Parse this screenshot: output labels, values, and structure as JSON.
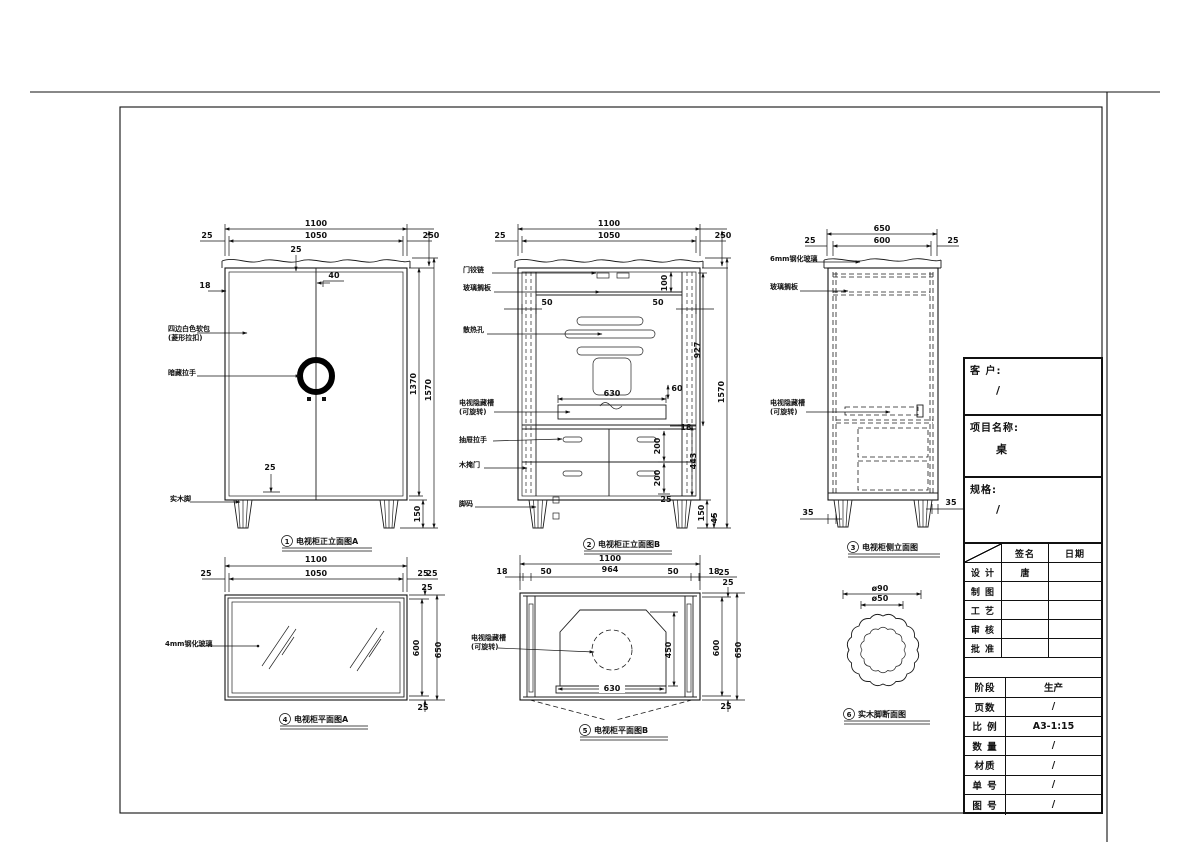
{
  "title_block": {
    "customer_label": "客 户:",
    "customer_value": "/",
    "project_label": "项目名称:",
    "project_value": "桌",
    "spec_label": "规格:",
    "spec_value": "/",
    "sign_col": "签名",
    "date_col": "日期",
    "sign_rows": [
      {
        "label": "设 计",
        "sign": "唐",
        "date": ""
      },
      {
        "label": "制 图",
        "sign": "",
        "date": ""
      },
      {
        "label": "工 艺",
        "sign": "",
        "date": ""
      },
      {
        "label": "审 核",
        "sign": "",
        "date": ""
      },
      {
        "label": "批 准",
        "sign": "",
        "date": ""
      }
    ],
    "info_rows": [
      {
        "label": "阶段",
        "value": "生产"
      },
      {
        "label": "页数",
        "value": "/"
      },
      {
        "label": "比 例",
        "value": "A3-1:15"
      },
      {
        "label": "数 量",
        "value": "/"
      },
      {
        "label": "材质",
        "value": "/"
      },
      {
        "label": "单 号",
        "value": "/"
      },
      {
        "label": "图 号",
        "value": "/"
      }
    ]
  },
  "views": {
    "v1": {
      "num": "1",
      "title": "电视柜正立面图A",
      "annotations": [
        {
          "x": 316,
          "y": 226,
          "t": "1100"
        },
        {
          "x": 207,
          "y": 238,
          "t": "25"
        },
        {
          "x": 316,
          "y": 238,
          "t": "1050"
        },
        {
          "x": 431,
          "y": 238,
          "t": "250"
        },
        {
          "x": 296,
          "y": 252,
          "t": "25"
        },
        {
          "x": 334,
          "y": 278,
          "t": "40"
        },
        {
          "x": 205,
          "y": 288,
          "t": "18"
        },
        {
          "x": 270,
          "y": 470,
          "t": "25"
        },
        {
          "x": 416,
          "y": 384,
          "t": "1370",
          "r": -90
        },
        {
          "x": 431,
          "y": 390,
          "t": "1570",
          "r": -90
        },
        {
          "x": 420,
          "y": 514,
          "t": "150",
          "r": -90
        },
        {
          "x": 168,
          "y": 331,
          "t": "四边白色软包",
          "s": 7,
          "a": "start"
        },
        {
          "x": 168,
          "y": 340,
          "t": "(菱形拉扣)",
          "s": 7,
          "a": "start"
        },
        {
          "x": 168,
          "y": 375,
          "t": "暗藏拉手",
          "s": 7,
          "a": "start"
        },
        {
          "x": 170,
          "y": 501,
          "t": "实木脚",
          "s": 7,
          "a": "start"
        }
      ]
    },
    "v2": {
      "num": "2",
      "title": "电视柜正立面图B",
      "annotations": [
        {
          "x": 609,
          "y": 226,
          "t": "1100"
        },
        {
          "x": 500,
          "y": 238,
          "t": "25"
        },
        {
          "x": 609,
          "y": 238,
          "t": "1050"
        },
        {
          "x": 723,
          "y": 238,
          "t": "250"
        },
        {
          "x": 547,
          "y": 305,
          "t": "50"
        },
        {
          "x": 658,
          "y": 305,
          "t": "50"
        },
        {
          "x": 667,
          "y": 283,
          "t": "100",
          "r": -90
        },
        {
          "x": 612,
          "y": 396,
          "t": "630"
        },
        {
          "x": 677,
          "y": 391,
          "t": "60"
        },
        {
          "x": 686,
          "y": 430,
          "t": "18"
        },
        {
          "x": 660,
          "y": 446,
          "t": "200",
          "r": -90
        },
        {
          "x": 660,
          "y": 478,
          "t": "200",
          "r": -90
        },
        {
          "x": 666,
          "y": 502,
          "t": "25"
        },
        {
          "x": 696,
          "y": 461,
          "t": "443",
          "r": -90
        },
        {
          "x": 700,
          "y": 350,
          "t": "927",
          "r": -90
        },
        {
          "x": 724,
          "y": 392,
          "t": "1570",
          "r": -90
        },
        {
          "x": 704,
          "y": 513,
          "t": "150",
          "r": -90
        },
        {
          "x": 717,
          "y": 518,
          "t": "45",
          "r": -90
        },
        {
          "x": 463,
          "y": 272,
          "t": "门铰链",
          "s": 7,
          "a": "start"
        },
        {
          "x": 463,
          "y": 290,
          "t": "玻璃搁板",
          "s": 7,
          "a": "start"
        },
        {
          "x": 463,
          "y": 332,
          "t": "散热孔",
          "s": 7,
          "a": "start"
        },
        {
          "x": 459,
          "y": 405,
          "t": "电视隐藏槽",
          "s": 7,
          "a": "start"
        },
        {
          "x": 459,
          "y": 414,
          "t": "(可旋转)",
          "s": 7,
          "a": "start"
        },
        {
          "x": 459,
          "y": 442,
          "t": "抽屉拉手",
          "s": 7,
          "a": "start"
        },
        {
          "x": 459,
          "y": 467,
          "t": "木掩门",
          "s": 7,
          "a": "start"
        },
        {
          "x": 459,
          "y": 506,
          "t": "脚码",
          "s": 7,
          "a": "start"
        }
      ]
    },
    "v3": {
      "num": "3",
      "title": "电视柜侧立面图",
      "annotations": [
        {
          "x": 882,
          "y": 231,
          "t": "650"
        },
        {
          "x": 810,
          "y": 243,
          "t": "25"
        },
        {
          "x": 882,
          "y": 243,
          "t": "600"
        },
        {
          "x": 953,
          "y": 243,
          "t": "25"
        },
        {
          "x": 808,
          "y": 515,
          "t": "35"
        },
        {
          "x": 951,
          "y": 505,
          "t": "35"
        },
        {
          "x": 770,
          "y": 261,
          "t": "6mm钢化玻璃",
          "s": 7,
          "a": "start"
        },
        {
          "x": 770,
          "y": 289,
          "t": "玻璃搁板",
          "s": 7,
          "a": "start"
        },
        {
          "x": 770,
          "y": 405,
          "t": "电视隐藏槽",
          "s": 7,
          "a": "start"
        },
        {
          "x": 770,
          "y": 414,
          "t": "(可旋转)",
          "s": 7,
          "a": "start"
        }
      ]
    },
    "v4": {
      "num": "4",
      "title": "电视柜平面图A",
      "annotations": [
        {
          "x": 316,
          "y": 562,
          "t": "1100"
        },
        {
          "x": 206,
          "y": 576,
          "t": "25"
        },
        {
          "x": 316,
          "y": 576,
          "t": "1050"
        },
        {
          "x": 423,
          "y": 576,
          "t": "25"
        },
        {
          "x": 432,
          "y": 576,
          "t": "25"
        },
        {
          "x": 427,
          "y": 590,
          "t": "25"
        },
        {
          "x": 419,
          "y": 648,
          "t": "600",
          "r": -90
        },
        {
          "x": 441,
          "y": 650,
          "t": "650",
          "r": -90
        },
        {
          "x": 423,
          "y": 710,
          "t": "25"
        },
        {
          "x": 165,
          "y": 646,
          "t": "4mm钢化玻璃",
          "s": 7,
          "a": "start"
        }
      ]
    },
    "v5": {
      "num": "5",
      "title": "电视柜平面图B",
      "annotations": [
        {
          "x": 610,
          "y": 561,
          "t": "1100"
        },
        {
          "x": 502,
          "y": 574,
          "t": "18"
        },
        {
          "x": 546,
          "y": 574,
          "t": "50"
        },
        {
          "x": 610,
          "y": 572,
          "t": "964"
        },
        {
          "x": 673,
          "y": 574,
          "t": "50"
        },
        {
          "x": 714,
          "y": 574,
          "t": "18"
        },
        {
          "x": 724,
          "y": 575,
          "t": "25"
        },
        {
          "x": 728,
          "y": 585,
          "t": "25"
        },
        {
          "x": 719,
          "y": 648,
          "t": "600",
          "r": -90
        },
        {
          "x": 741,
          "y": 650,
          "t": "650",
          "r": -90
        },
        {
          "x": 726,
          "y": 709,
          "t": "25"
        },
        {
          "x": 671,
          "y": 650,
          "t": "450",
          "r": -90
        },
        {
          "x": 612,
          "y": 691,
          "t": "630"
        },
        {
          "x": 471,
          "y": 640,
          "t": "电视隐藏槽",
          "s": 7,
          "a": "start"
        },
        {
          "x": 471,
          "y": 649,
          "t": "(可旋转)",
          "s": 7,
          "a": "start"
        }
      ]
    },
    "v6": {
      "num": "6",
      "title": "实木脚断面图",
      "annotations": [
        {
          "x": 880,
          "y": 591,
          "t": "ø90"
        },
        {
          "x": 880,
          "y": 601,
          "t": "ø50"
        }
      ]
    }
  }
}
